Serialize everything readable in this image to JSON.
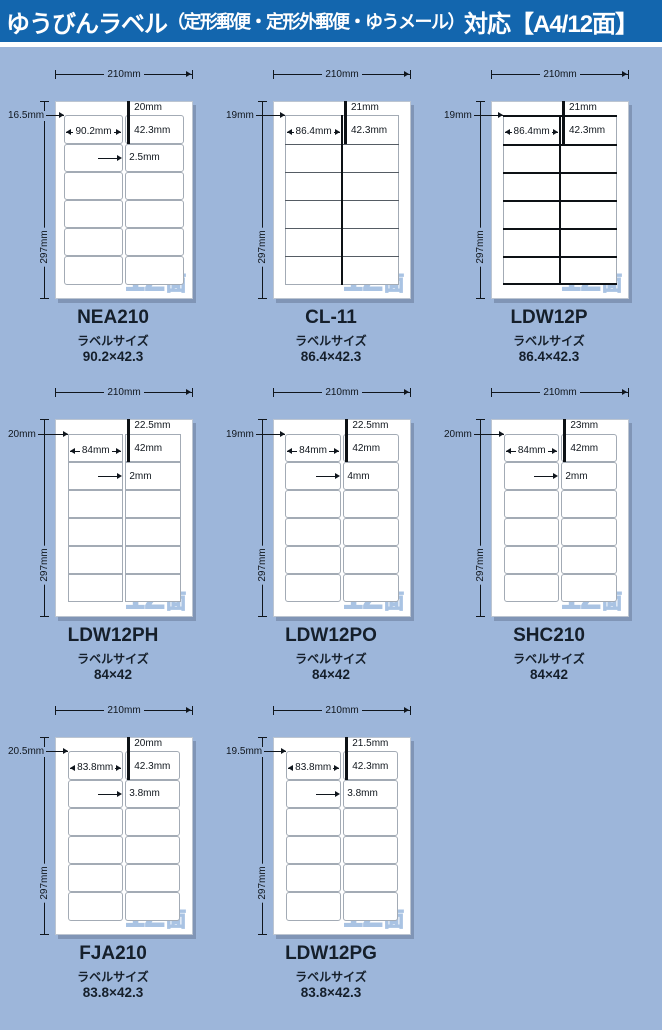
{
  "header": {
    "title_main": "ゆうびんラベル",
    "title_paren": "（定形郵便・定形外郵便・ゆうメール）",
    "title_suffix": "対応【A4/12面】"
  },
  "colors": {
    "header_bg": "#1366ae",
    "body_bg": "#9db6da",
    "badge_blue": "#a9c3e3",
    "ink": "#10161d",
    "thick_line": "#0d1115",
    "thin_border": "#a3abb5"
  },
  "panels": [
    {
      "code": "NEA210",
      "label_size_caption": "ラベルサイズ",
      "size": "90.2×42.3",
      "badge_count": "12",
      "badge_unit": "面",
      "style": "rounded",
      "dims": {
        "sheet_width": "210mm",
        "sheet_height": "297mm",
        "top_margin": "20mm",
        "side_margin": "16.5mm",
        "label_width": "90.2mm",
        "label_height": "42.3mm",
        "gap": "2.5mm"
      }
    },
    {
      "code": "CL-11",
      "label_size_caption": "ラベルサイズ",
      "size": "86.4×42.3",
      "badge_count": "12",
      "badge_unit": "面",
      "style": "merged",
      "dims": {
        "sheet_width": "210mm",
        "sheet_height": "297mm",
        "top_margin": "21mm",
        "side_margin": "19mm",
        "label_width": "86.4mm",
        "label_height": "42.3mm"
      }
    },
    {
      "code": "LDW12P",
      "label_size_caption": "ラベルサイズ",
      "size": "86.4×42.3",
      "badge_count": "12",
      "badge_unit": "面",
      "style": "thick",
      "dims": {
        "sheet_width": "210mm",
        "sheet_height": "297mm",
        "top_margin": "21mm",
        "side_margin": "19mm",
        "label_width": "86.4mm",
        "label_height": "42.3mm"
      }
    },
    {
      "code": "LDW12PH",
      "label_size_caption": "ラベルサイズ",
      "size": "84×42",
      "badge_count": "12",
      "badge_unit": "面",
      "style": "square",
      "dims": {
        "sheet_width": "210mm",
        "sheet_height": "297mm",
        "top_margin": "22.5mm",
        "side_margin": "20mm",
        "label_width": "84mm",
        "label_height": "42mm",
        "gap": "2mm"
      }
    },
    {
      "code": "LDW12PO",
      "label_size_caption": "ラベルサイズ",
      "size": "84×42",
      "badge_count": "12",
      "badge_unit": "面",
      "style": "rounded",
      "dims": {
        "sheet_width": "210mm",
        "sheet_height": "297mm",
        "top_margin": "22.5mm",
        "side_margin": "19mm",
        "label_width": "84mm",
        "label_height": "42mm",
        "gap": "4mm"
      }
    },
    {
      "code": "SHC210",
      "label_size_caption": "ラベルサイズ",
      "size": "84×42",
      "badge_count": "12",
      "badge_unit": "面",
      "style": "rounded",
      "dims": {
        "sheet_width": "210mm",
        "sheet_height": "297mm",
        "top_margin": "23mm",
        "side_margin": "20mm",
        "label_width": "84mm",
        "label_height": "42mm",
        "gap": "2mm"
      }
    },
    {
      "code": "FJA210",
      "label_size_caption": "ラベルサイズ",
      "size": "83.8×42.3",
      "badge_count": "12",
      "badge_unit": "面",
      "style": "rounded",
      "dims": {
        "sheet_width": "210mm",
        "sheet_height": "297mm",
        "top_margin": "20mm",
        "side_margin": "20.5mm",
        "label_width": "83.8mm",
        "label_height": "42.3mm",
        "gap": "3.8mm"
      }
    },
    {
      "code": "LDW12PG",
      "label_size_caption": "ラベルサイズ",
      "size": "83.8×42.3",
      "badge_count": "12",
      "badge_unit": "面",
      "style": "rounded",
      "dims": {
        "sheet_width": "210mm",
        "sheet_height": "297mm",
        "top_margin": "21.5mm",
        "side_margin": "19.5mm",
        "label_width": "83.8mm",
        "label_height": "42.3mm",
        "gap": "3.8mm"
      }
    }
  ]
}
